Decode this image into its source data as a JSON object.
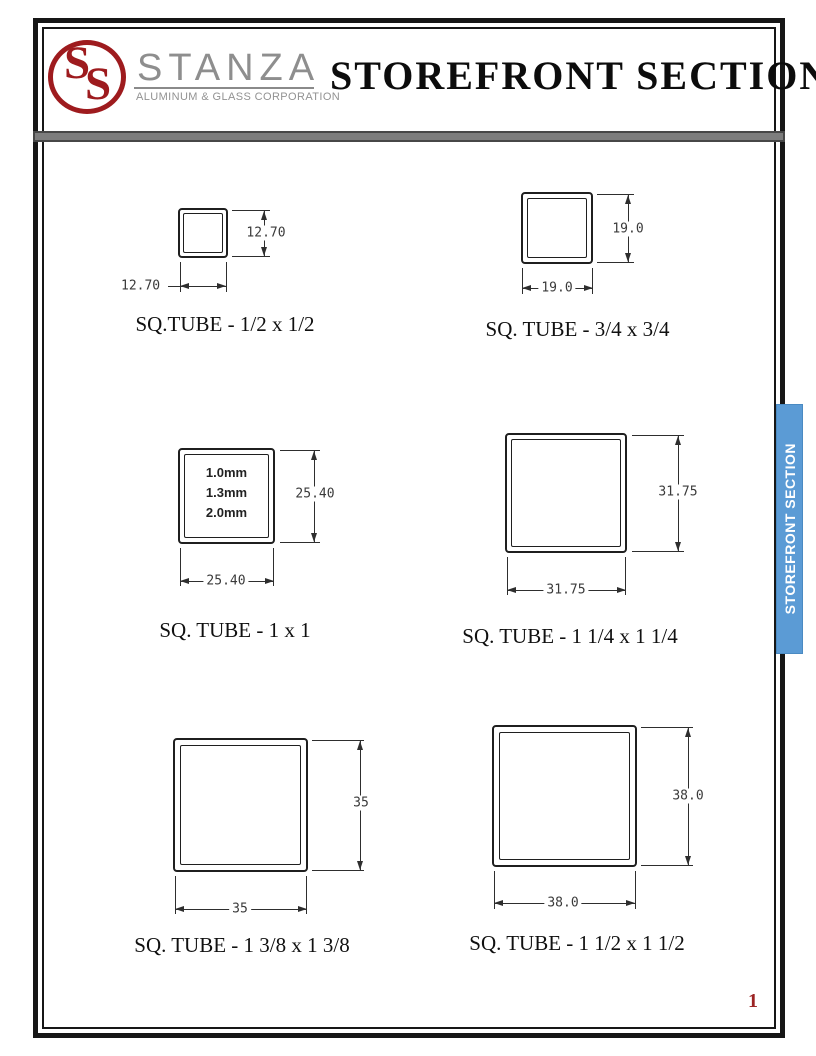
{
  "header": {
    "logo_monogram_s1": "S",
    "logo_monogram_s2": "S",
    "brand": "STANZA",
    "tagline": "ALUMINUM & GLASS CORPORATION",
    "title": "STOREFRONT SECTION"
  },
  "side_tab": {
    "label": "STOREFRONT SECTION"
  },
  "page": {
    "number": "1"
  },
  "colors": {
    "brand_red": "#9e1b1e",
    "tab_blue": "#5b9bd5",
    "divider_gray": "#7d7d7d",
    "line_dark": "#2e2e2e",
    "page_number_red": "#9c2424"
  },
  "diagrams": [
    {
      "caption": "SQ.TUBE - 1/2 x 1/2",
      "width_label": "12.70",
      "height_label": "12.70"
    },
    {
      "caption": "SQ. TUBE - 3/4 x 3/4",
      "width_label": "19.0",
      "height_label": "19.0"
    },
    {
      "caption": "SQ. TUBE - 1 x 1",
      "width_label": "25.40",
      "height_label": "25.40",
      "thickness_options": [
        "1.0mm",
        "1.3mm",
        "2.0mm"
      ]
    },
    {
      "caption": "SQ. TUBE - 1 1/4 x 1 1/4",
      "width_label": "31.75",
      "height_label": "31.75"
    },
    {
      "caption": "SQ. TUBE - 1 3/8 x 1 3/8",
      "width_label": "35",
      "height_label": "35"
    },
    {
      "caption": "SQ. TUBE - 1 1/2 x 1 1/2",
      "width_label": "38.0",
      "height_label": "38.0"
    }
  ]
}
